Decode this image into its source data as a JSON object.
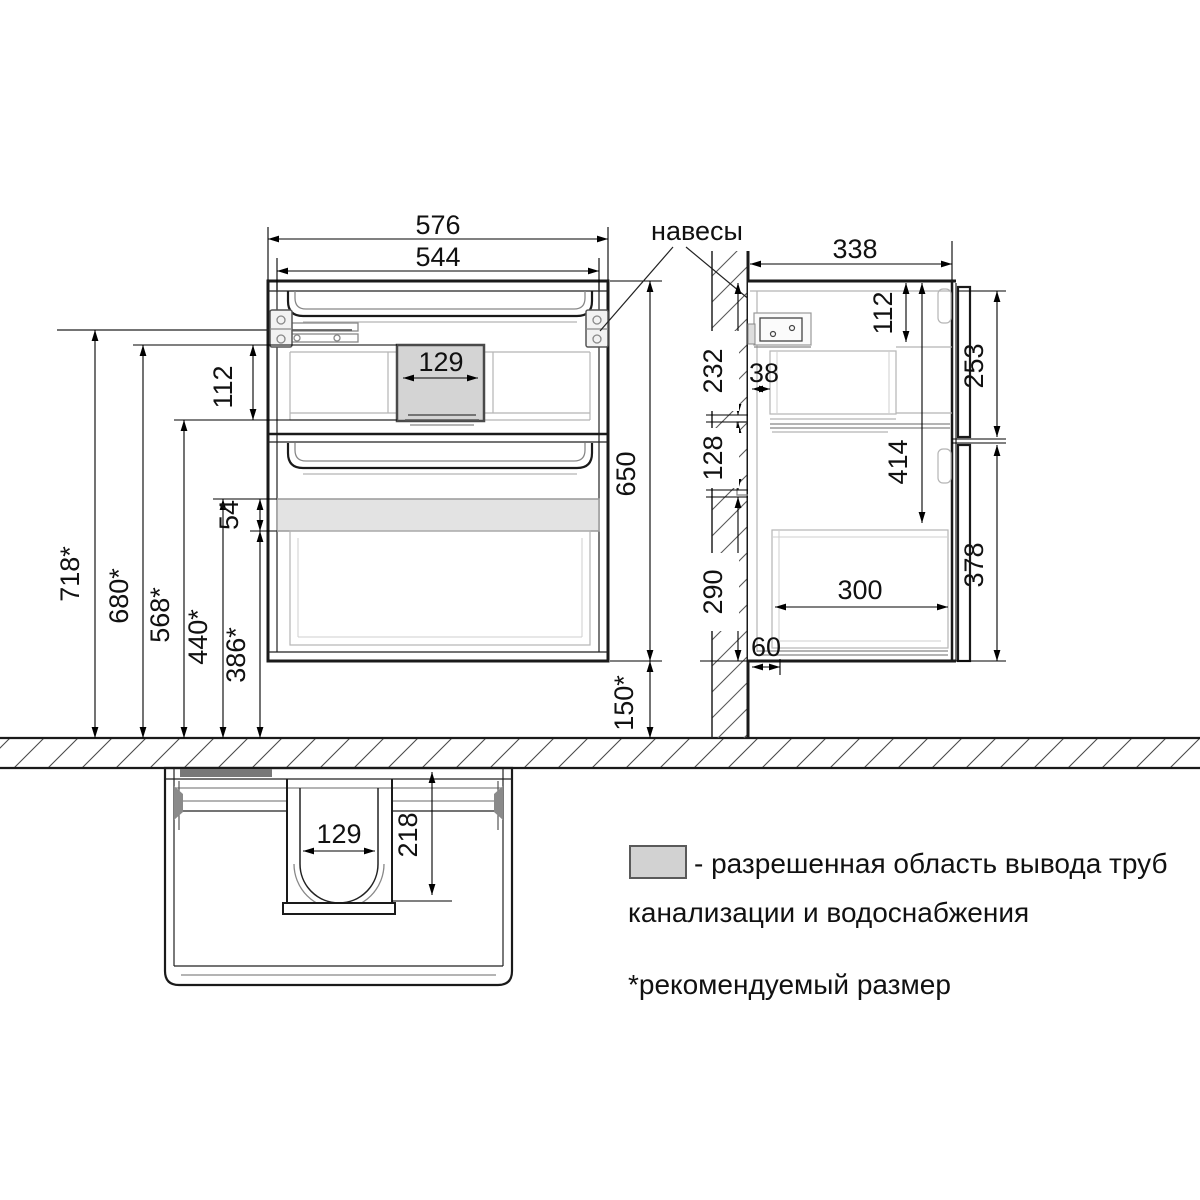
{
  "labels": {
    "hinges": "навесы"
  },
  "front": {
    "width_total": "576",
    "width_inner": "544",
    "pipe_box_width": "129",
    "pipe_box_height": "112",
    "height": "650",
    "floor_clearance": "150*"
  },
  "install_heights": {
    "rail_level": "718*",
    "zone_top": "680*",
    "zone_bottom": "568*",
    "band_top": "440*",
    "band_bottom": "386*",
    "band_height": "54"
  },
  "side": {
    "depth": "338",
    "wall_above_zone": "232",
    "wall_zone_height": "128",
    "wall_below_zone": "290",
    "back_clearance": "38",
    "top_inset": "112",
    "inner_height": "414",
    "upper_front_height": "253",
    "lower_front_height": "378",
    "drawer_inner_depth": "300",
    "bottom_back_clearance": "60"
  },
  "bottom_view": {
    "cutout_width": "129",
    "cutout_depth": "218"
  },
  "colors": {
    "zone_fill": "#d4d4d4",
    "band_fill": "#e3e3e3",
    "swatch_fill": "#d2d2d2",
    "rail_bar": "#787878"
  },
  "legend": {
    "line1": "- разрешенная область вывода труб",
    "line2": "канализации и водоснабжения",
    "note": "*рекомендуемый размер"
  }
}
